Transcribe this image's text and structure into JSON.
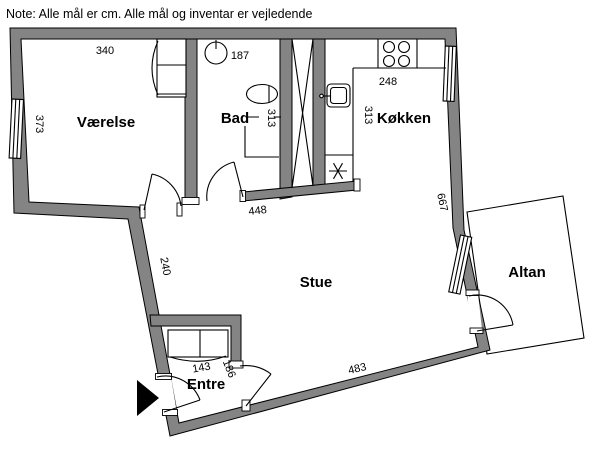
{
  "note": "Note: Alle mål er cm. Alle mål og inventar er vejledende",
  "rooms": {
    "vaerelse": "Værelse",
    "bad": "Bad",
    "koekken": "Køkken",
    "stue": "Stue",
    "altan": "Altan",
    "entre": "Entre"
  },
  "dimensions": {
    "vaerelse_width": "340",
    "vaerelse_depth": "373",
    "bad_width": "187",
    "bad_depth": "313",
    "koekken_width": "248",
    "koekken_depth": "313",
    "right_wall": "667",
    "stue_top": "448",
    "entre_wall": "240",
    "entre_closet_width": "143",
    "entre_depth": "186",
    "stue_bottom": "483"
  },
  "colors": {
    "wall_fill": "#848484",
    "outline": "#000000",
    "background": "#ffffff"
  }
}
